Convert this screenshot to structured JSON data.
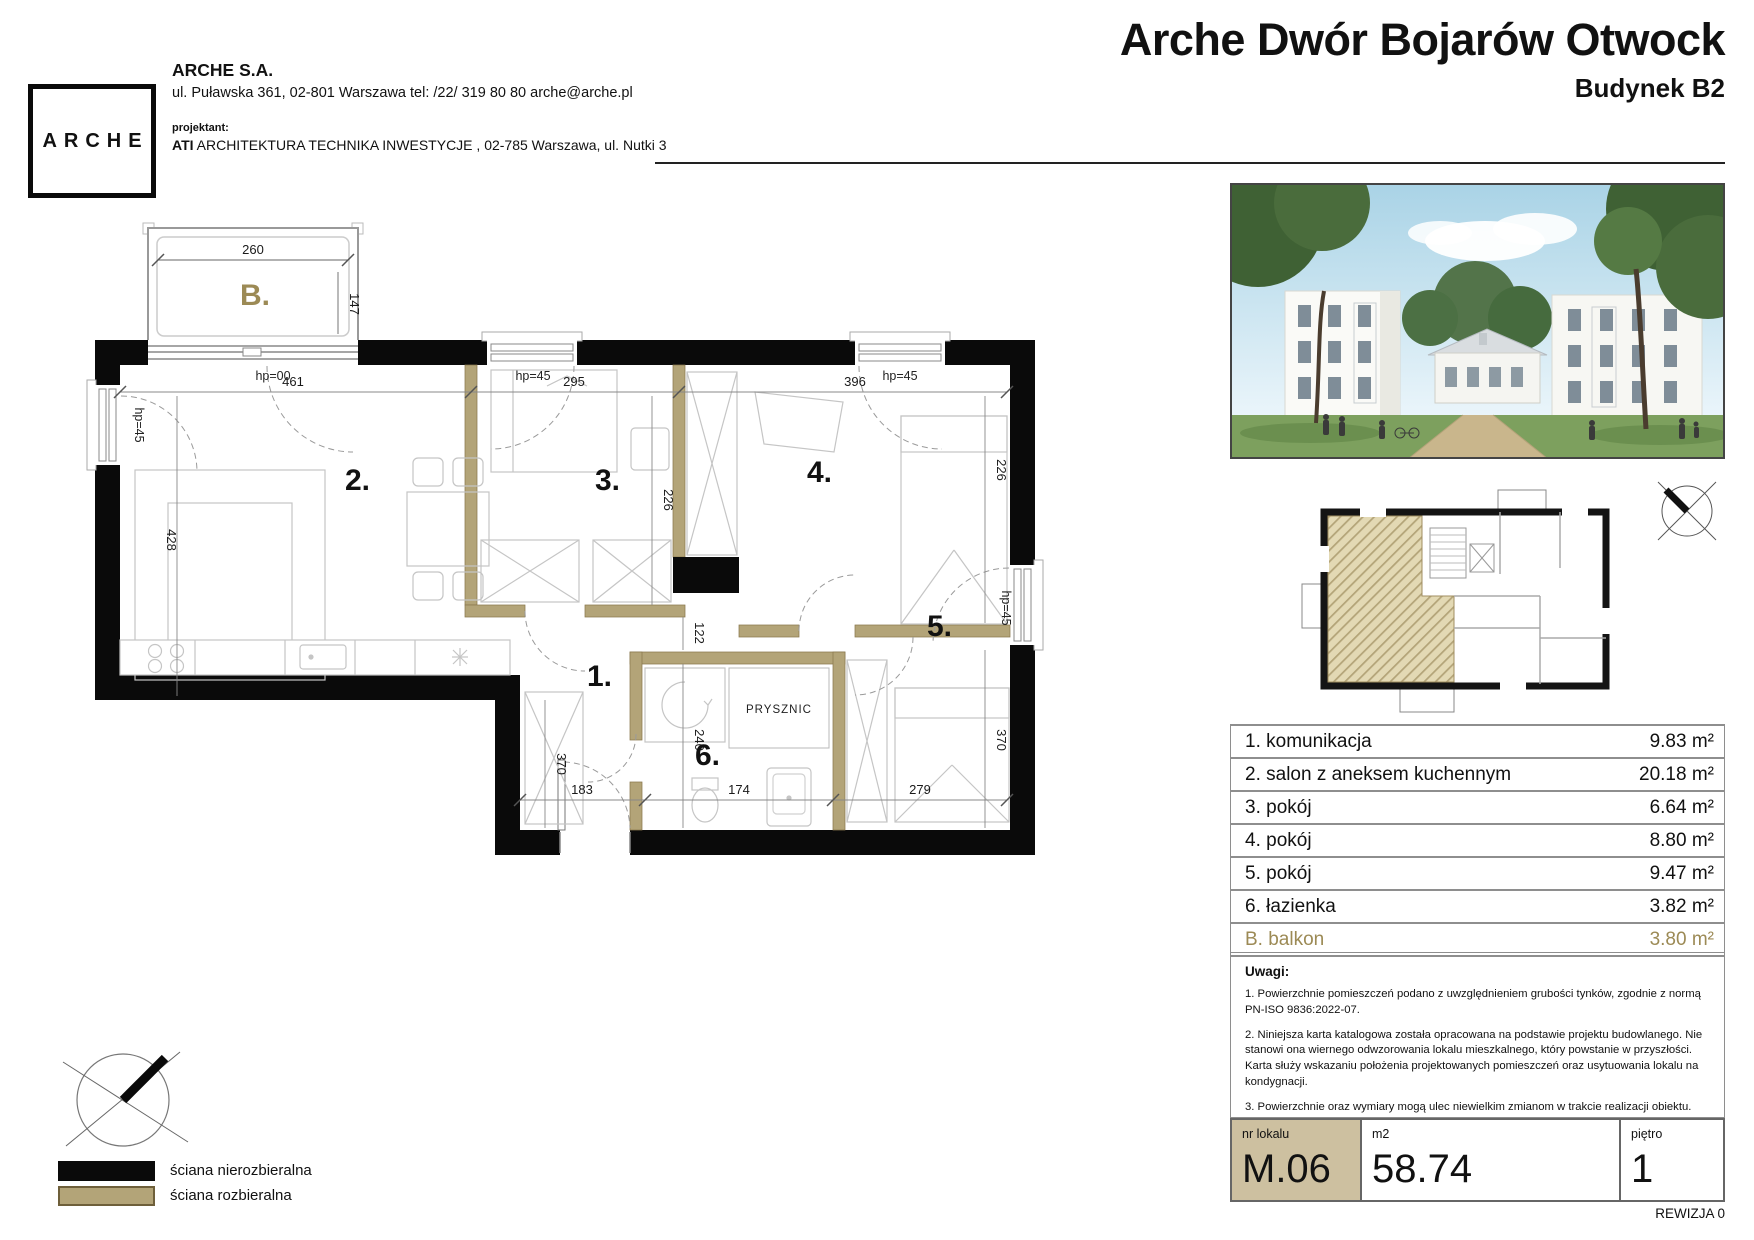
{
  "header": {
    "logo_text": "ARCHE",
    "company_name": "ARCHE S.A.",
    "company_address": "ul. Puławska 361, 02-801 Warszawa tel: /22/ 319 80 80 arche@arche.pl",
    "designer_label": "projektant:",
    "designer_abbr": "ATI",
    "designer_rest": " ARCHITEKTURA TECHNIKA INWESTYCJE , 02-785 Warszawa, ul. Nutki 3",
    "project_title": "Arche Dwór Bojarów Otwock",
    "building": "Budynek B2"
  },
  "plan": {
    "labels": {
      "balcony": "B.",
      "r1": "1.",
      "r2": "2.",
      "r3": "3.",
      "r4": "4.",
      "r5": "5.",
      "r6": "6.",
      "shower": "PRYSZNIC"
    },
    "dims": {
      "balcony_w": "260",
      "balcony_d": "147",
      "salon_w": "461",
      "salon_d": "428",
      "p3_w": "295",
      "p3_d": "226",
      "p4_w": "396",
      "p4_d": "226",
      "hall_d": "122",
      "d240": "240",
      "d370l": "370",
      "d370r": "370",
      "d183": "183",
      "d174": "174",
      "d279": "279"
    },
    "hp00": "hp=00",
    "hp45": "hp=45"
  },
  "legend": {
    "items": [
      {
        "label": "ściana nierozbieralna",
        "color": "#0a0a0a"
      },
      {
        "label": "ściana rozbieralna",
        "color": "#b3a478"
      }
    ]
  },
  "rooms_table": {
    "rows": [
      {
        "name": "1. komunikacja",
        "area": "9.83 m²"
      },
      {
        "name": "2. salon z aneksem kuchennym",
        "area": "20.18 m²"
      },
      {
        "name": "3. pokój",
        "area": "6.64 m²"
      },
      {
        "name": "4. pokój",
        "area": "8.80 m²"
      },
      {
        "name": "5. pokój",
        "area": "9.47 m²"
      },
      {
        "name": "6. łazienka",
        "area": "3.82 m²"
      },
      {
        "name": "B. balkon",
        "area": "3.80 m²"
      }
    ]
  },
  "notes": {
    "title": "Uwagi:",
    "items": [
      "1. Powierzchnie pomieszczeń podano z uwzględnieniem grubości tynków, zgodnie z normą PN-ISO 9836:2022-07.",
      "2. Niniejsza karta katalogowa została opracowana na podstawie projektu budowlanego. Nie stanowi ona wiernego odwzorowania lokalu mieszkalnego, który powstanie w przyszłości. Karta służy wskazaniu położenia projektowanych pomieszczeń oraz usytuowania lokalu na kondygnacji.",
      "3. Powierzchnie oraz wymiary mogą ulec niewielkim zmianom w trakcie realizacji obiektu."
    ]
  },
  "summary": {
    "unit_label": "nr lokalu",
    "unit": "M.06",
    "area_label": "m2",
    "area": "58.74",
    "floor_label": "piętro",
    "floor": "1"
  },
  "revision": "REWIZJA 0",
  "colors": {
    "wall_black": "#0a0a0a",
    "wall_tan": "#b3a478",
    "gold_text": "#9c8a55",
    "unit_cell_bg": "#cdc0a0"
  }
}
